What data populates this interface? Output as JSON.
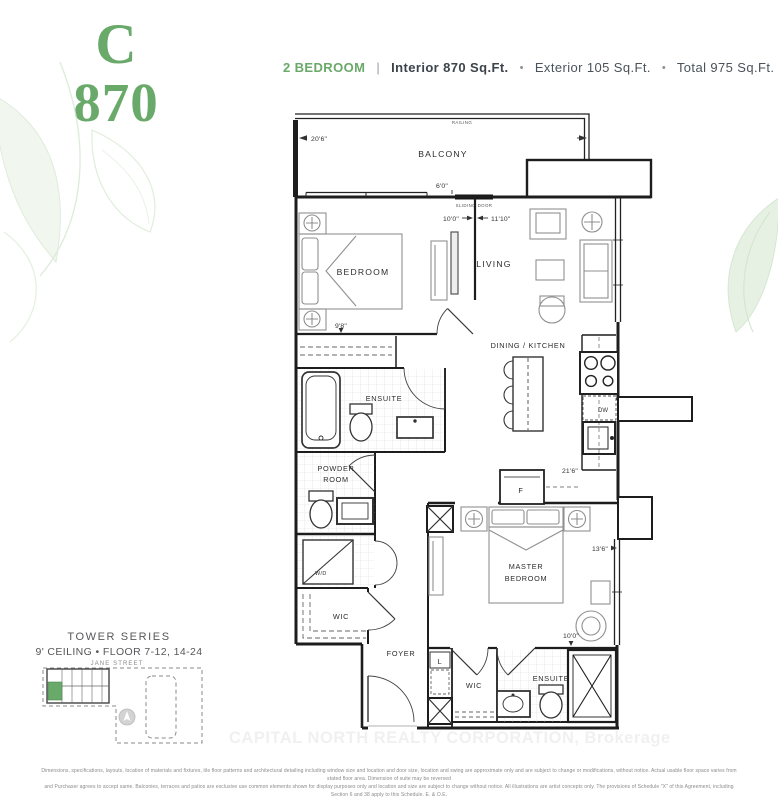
{
  "unit": {
    "letter": "C",
    "number": "870"
  },
  "header": {
    "type": "2 BEDROOM",
    "divider": "|",
    "interior": "Interior 870 Sq.Ft.",
    "bullet": "•",
    "exterior": "Exterior 105 Sq.Ft.",
    "total": "Total 975 Sq.Ft."
  },
  "plan": {
    "rooms": {
      "balcony": "BALCONY",
      "bedroom": "BEDROOM",
      "living": "LIVING",
      "dining_kitchen": "DINING / KITCHEN",
      "ensuite": "ENSUITE",
      "powder_line1": "POWDER",
      "powder_line2": "ROOM",
      "wd": "W/D",
      "wic": "WIC",
      "foyer": "FOYER",
      "linen": "L",
      "master_line1": "MASTER",
      "master_line2": "BEDROOM",
      "wic2": "WIC",
      "master_ensuite": "ENSUITE"
    },
    "fixtures": {
      "fridge": "F",
      "dishwasher": "DW"
    },
    "annotations": {
      "railing": "RAILING",
      "sliding_door": "SLIDING DOOR"
    },
    "dims": {
      "balcony_width": "20'6\"",
      "balcony_door": "6'0\"",
      "bedroom_width": "10'0\"",
      "living_width": "11'10\"",
      "bedroom_depth": "9'8\"",
      "kitchen_run": "21'6\"",
      "master_depth": "13'6\"",
      "master_width": "10'0\""
    }
  },
  "keyplan": {
    "series": "TOWER SERIES",
    "details": "9' CEILING • FLOOR 7-12, 14-24",
    "street": "JANE STREET"
  },
  "watermark": "CAPITAL NORTH REALTY CORPORATION, Brokerage",
  "disclaimer": {
    "line1": "Dimensions, specifications, layouts, location of materials and fixtures, tile floor patterns and architectural detailing including window size and location and door size, location and swing are approximate only and are subject to change or modifications, without notice. Actual usable floor space varies from stated floor area. Dimension of suite may be reversed",
    "line2": "and Purchaser agrees to accept same. Balconies, terraces and patios are exclusive use common elements shown for display purposes only and location and size are subject to change without notice. All illustrations are artist concepts only. The provisions of Schedule \"X\" of this Agreement, including Section 6 and 38 apply to this Schedule. E. & O.E."
  },
  "colors": {
    "brand_green": "#69a969",
    "text_dark": "#3c434b"
  }
}
